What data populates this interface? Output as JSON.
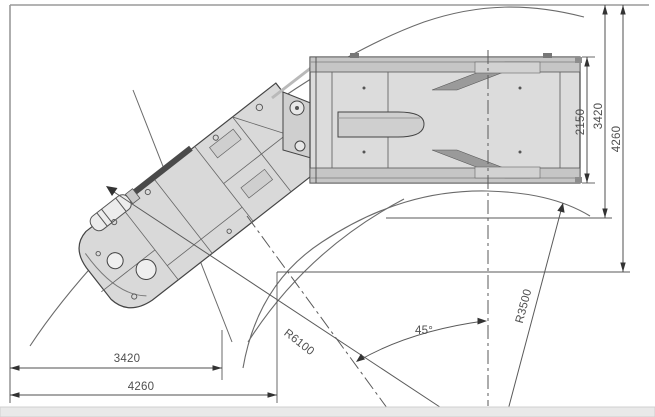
{
  "drawing": {
    "title": "articulated-vehicle-turning-clearance-top-view",
    "labels": {
      "body_width": "2150",
      "right_width_inner": "3420",
      "right_width_outer": "4260",
      "bottom_width_inner": "3420",
      "bottom_width_outer": "4260",
      "outer_turn_radius": "R6100",
      "inner_turn_radius": "R3500",
      "articulation_angle": "45°"
    },
    "colors": {
      "line": "#4f4f4f",
      "reference_line": "#9a9a9a",
      "vehicle_fill": "#d9d9d9",
      "vehicle_fill_dark": "#a8a8a8",
      "bottom_strip": "#e9e9e9"
    }
  }
}
